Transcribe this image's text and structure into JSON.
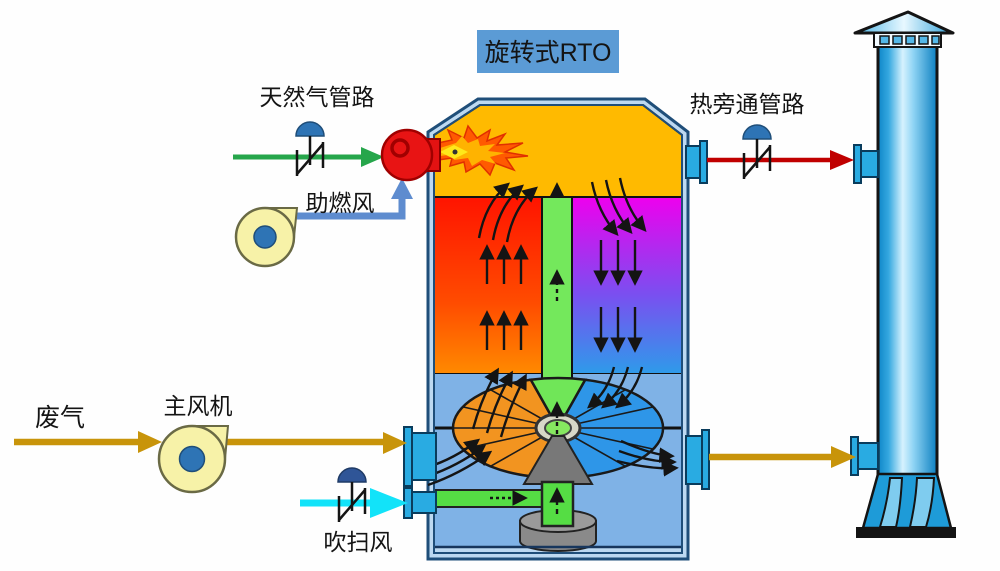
{
  "diagram": {
    "title": "旋转式RTO",
    "labels": {
      "natural_gas_line": "天然气管路",
      "combustion_air": "助燃风",
      "hot_bypass_line": "热旁通管路",
      "waste_gas": "废气",
      "main_fan": "主风机",
      "purge_air": "吹扫风"
    },
    "components": {
      "vessel": "rotary-rto-vessel",
      "combustion_chamber": "combustion-chamber",
      "heating_bed": "regenerator-bed-heating",
      "cooling_bed": "regenerator-bed-cooling",
      "purge_column": "purge-column",
      "rotary_distributor": "rotary-distributor-disc",
      "burner": "gas-burner",
      "stack": "exhaust-stack",
      "main_fan": "main-fan-blower",
      "combustion_air_fan": "combustion-air-blower",
      "valves": "manual-valve"
    },
    "colors": {
      "title_box": "#5B9BD5",
      "combustion_chamber": "#FFBA00",
      "bed_hot_top": "#FF1400",
      "bed_hot_bottom": "#FF8A00",
      "bed_cold_top": "#EE00EE",
      "bed_cold_bottom": "#2E9BEA",
      "purge_green": "#70E65A",
      "plenum_blue": "#7FB2E6",
      "vessel_outline": "#1F4E79",
      "natural_gas_line": "#26A64B",
      "combustion_air_line": "#5E8CCF",
      "waste_gas_line": "#C8940A",
      "hot_bypass_line": "#C00000",
      "purge_air_line": "#12E3F9",
      "stack_blue": "#1E9BD8",
      "nozzle_cyan": "#29ABE2",
      "burner_red": "#E81414",
      "fan_body": "#F7F2A8",
      "fan_hub": "#2E74B5"
    }
  }
}
